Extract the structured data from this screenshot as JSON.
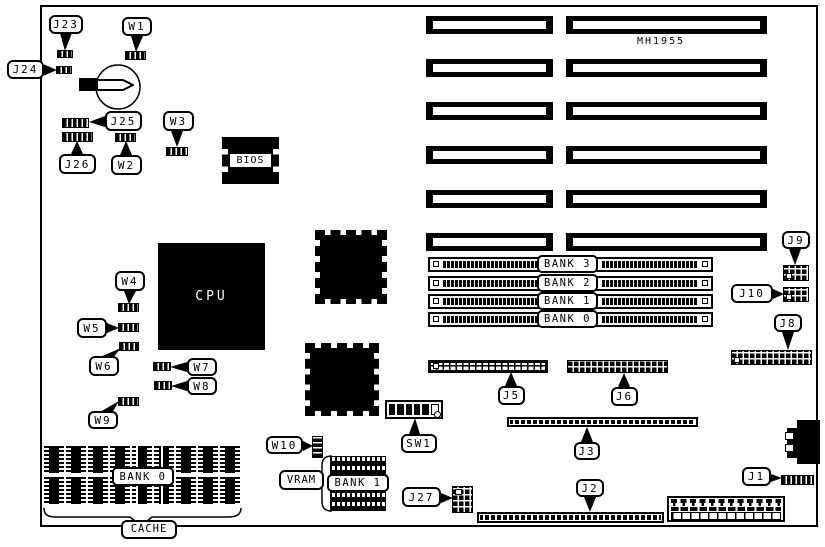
{
  "board": {
    "part_number": "MH1955"
  },
  "chips": {
    "cpu": "CPU",
    "bios": "BIOS"
  },
  "jumpers": {
    "w1": "W1",
    "w2": "W2",
    "w3": "W3",
    "w4": "W4",
    "w5": "W5",
    "w6": "W6",
    "w7": "W7",
    "w8": "W8",
    "w9": "W9",
    "w10": "W10"
  },
  "connectors": {
    "j1": "J1",
    "j2": "J2",
    "j3": "J3",
    "j5": "J5",
    "j6": "J6",
    "j8": "J8",
    "j9": "J9",
    "j10": "J10",
    "j23": "J23",
    "j24": "J24",
    "j25": "J25",
    "j26": "J26",
    "j27": "J27"
  },
  "switches": {
    "sw1": "SW1"
  },
  "memory": {
    "simm_banks": [
      "BANK 3",
      "BANK 2",
      "BANK 1",
      "BANK 0"
    ],
    "vram": "VRAM",
    "vram_bank": "BANK 1",
    "cache": "CACHE",
    "cache_bank": "BANK 0"
  }
}
